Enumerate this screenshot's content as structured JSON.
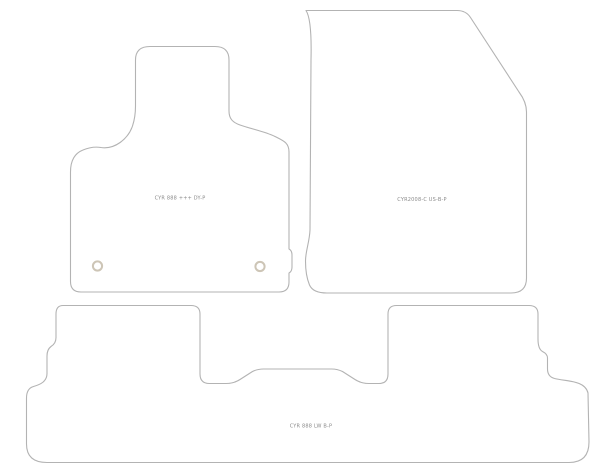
{
  "diagram": {
    "type": "car-floor-mat-cutting-template",
    "background_color": "#ffffff",
    "outline_color": "#b3b3b3",
    "label_color": "#8a8a8a",
    "grommet_color": "#cdc5b6",
    "mats": [
      {
        "position": "driver-front",
        "part_code": "CYR 888 +++ DY-P",
        "grommet_count": 2
      },
      {
        "position": "passenger-front",
        "part_code": "CYR2008-C US-B-P",
        "grommet_count": 0
      },
      {
        "position": "rear-full-width",
        "part_code": "CYR 888 LW B-P",
        "grommet_count": 0
      }
    ]
  }
}
